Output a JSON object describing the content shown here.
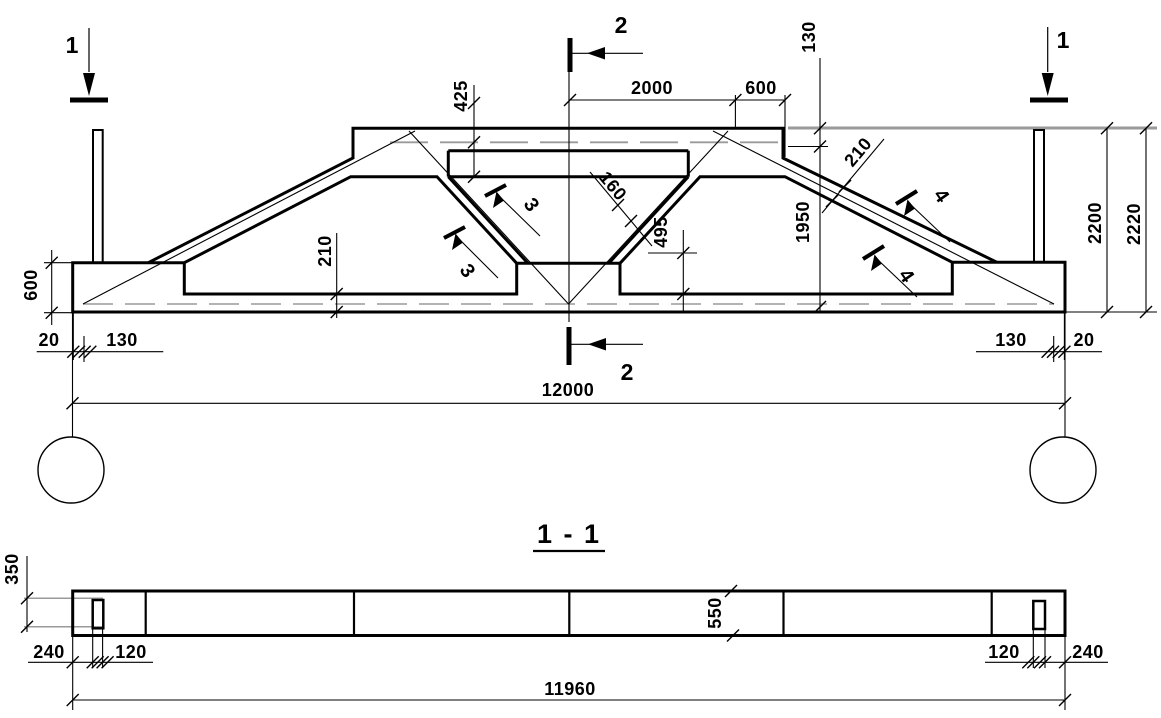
{
  "drawing": {
    "type": "structural truss elevation with section",
    "colors": {
      "line": "#000000",
      "gray": "#9a9a9a",
      "background": "#ffffff"
    },
    "markers": {
      "left_top": "1",
      "right_top": "1",
      "top_center": "2",
      "bottom_center": "2",
      "detail_left_upper": "3",
      "detail_left_lower": "3",
      "detail_right_upper": "4",
      "detail_right_lower": "4"
    },
    "main_dims": {
      "d425": "425",
      "d2000": "2000",
      "d600_top": "600",
      "d130_top": "130",
      "d210_diag": "210",
      "d160": "160",
      "d1950": "1950",
      "d495": "495",
      "d210_chord": "210",
      "d2200": "2200",
      "d2220": "2220",
      "d600_left": "600",
      "d20_left": "20",
      "d130_left": "130",
      "d130_right": "130",
      "d20_right": "20",
      "d12000": "12000"
    },
    "section": {
      "title": "1 - 1",
      "d350": "350",
      "d550": "550",
      "d240_left": "240",
      "d120_left": "120",
      "d120_right": "120",
      "d240_right": "240",
      "d11960": "11960"
    }
  }
}
